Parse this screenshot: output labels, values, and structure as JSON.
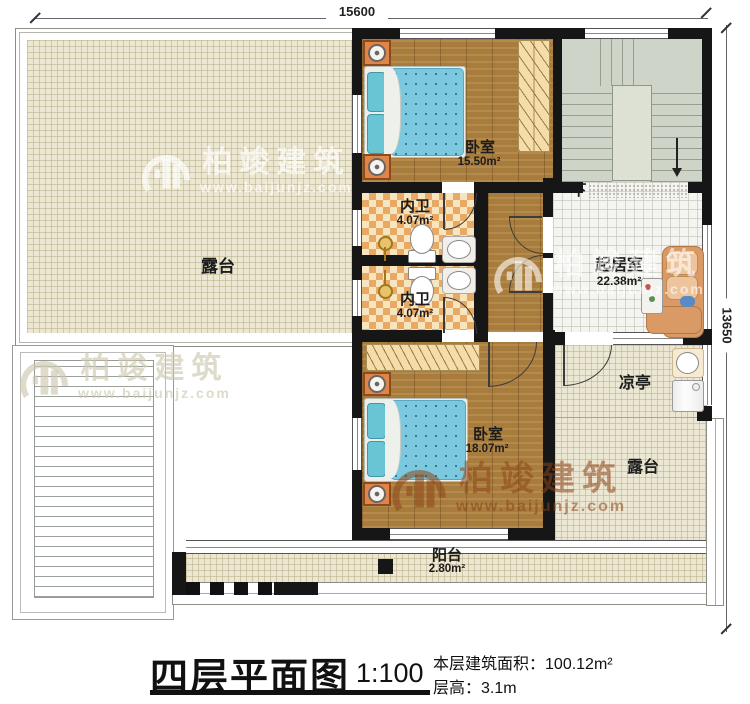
{
  "dims": {
    "top": "15600",
    "right": "13650"
  },
  "stairs": {
    "down": "下"
  },
  "rooms": {
    "terrace_left": {
      "name": "露台"
    },
    "bedroom_top": {
      "name": "卧室",
      "area": "15.50m²"
    },
    "bath_top": {
      "name": "内卫",
      "area": "4.07m²"
    },
    "bath_bottom": {
      "name": "内卫",
      "area": "4.07m²"
    },
    "living": {
      "name": "起居室",
      "area": "22.38m²"
    },
    "bedroom_bottom": {
      "name": "卧室",
      "area": "18.07m²"
    },
    "pavilion": {
      "name": "凉亭"
    },
    "terrace_right": {
      "name": "露台"
    },
    "balcony": {
      "name": "阳台",
      "area": "2.80m²"
    }
  },
  "watermark": {
    "brand": "柏竣建筑",
    "url": "www.baijunjz.com"
  },
  "titleblock": {
    "title": "四层平面图",
    "scale": "1:100",
    "area_label": "本层建筑面积：",
    "area_value": "100.12m²",
    "height_label": "层高：",
    "height_value": "3.1m"
  },
  "colors": {
    "wall": "#161616",
    "wood_floor": "#a87c3c",
    "terrace_tile": "#ece7d2",
    "bath_checker": "#e7a963",
    "stair": "#ced5c8",
    "bed_blue": "#7cc8de",
    "sofa_tan": "#d99a66"
  }
}
